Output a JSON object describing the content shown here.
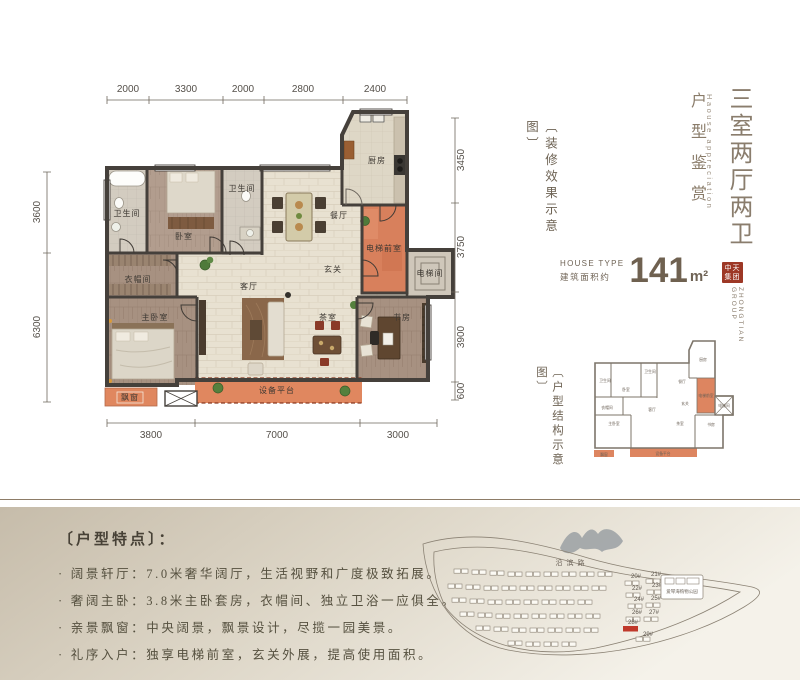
{
  "title_block": {
    "main_title": "三室两厅两卫",
    "subtitle": "户型鉴赏",
    "subtitle_en": "Haouse appreciation",
    "deco_note": "〔装修效果示意图〕",
    "structure_note": "〔户型结构示意图〕",
    "house_type_label": "HOUSE TYPE",
    "area_label": "建筑面积约",
    "area_value": "141",
    "area_unit": "m²",
    "logo": {
      "line1": "中天",
      "line2": "集团",
      "en": "ZHONGTIAN GROUP"
    }
  },
  "plan": {
    "rooms": {
      "kitchen": "厨房",
      "bath1": "卫生间",
      "bath2": "卫生间",
      "bedroom": "卧室",
      "cloakroom": "衣帽间",
      "master": "主卧室",
      "living": "客厅",
      "dining": "餐厅",
      "foyer": "玄关",
      "tea": "茶室",
      "lobby": "电梯前室",
      "elevator": "电梯间",
      "study": "书房",
      "platform": "设备平台",
      "bay": "飘窗"
    },
    "dims": {
      "top": [
        "2000",
        "3300",
        "2000",
        "2800",
        "2400"
      ],
      "bottom": [
        "3800",
        "7000",
        "3000"
      ],
      "left": [
        "3600",
        "6300"
      ],
      "right": [
        "3450",
        "3750",
        "3900",
        "600"
      ]
    }
  },
  "features": {
    "title": "〔户型特点〕：",
    "bullet": "·",
    "items": [
      "阔景轩厅：7.0米奢华阔厅，生活视野和广度极致拓展。",
      "奢阔主卧：3.8米主卧套房，衣帽间、独立卫浴一应俱全。",
      "亲景飘窗：中央阔景，飘景设计，尽揽一园美景。",
      "礼序入户：独享电梯前室，玄关外展，提高使用面积。"
    ]
  },
  "sitemap": {
    "road": "沿滨路",
    "poi": "爱琴海购物公园",
    "buildings": [
      "20#",
      "21#",
      "22#",
      "23#",
      "24#",
      "25#",
      "26#",
      "27#",
      "28#",
      "29#"
    ],
    "highlight": "28#"
  },
  "colors": {
    "accent_orange": "#dd8560",
    "wall": "#45403b",
    "logo_red": "#9d3826",
    "highlight_red": "#c0392b",
    "band_from": "#c6bcaa",
    "band_to": "#f5f2ea"
  }
}
